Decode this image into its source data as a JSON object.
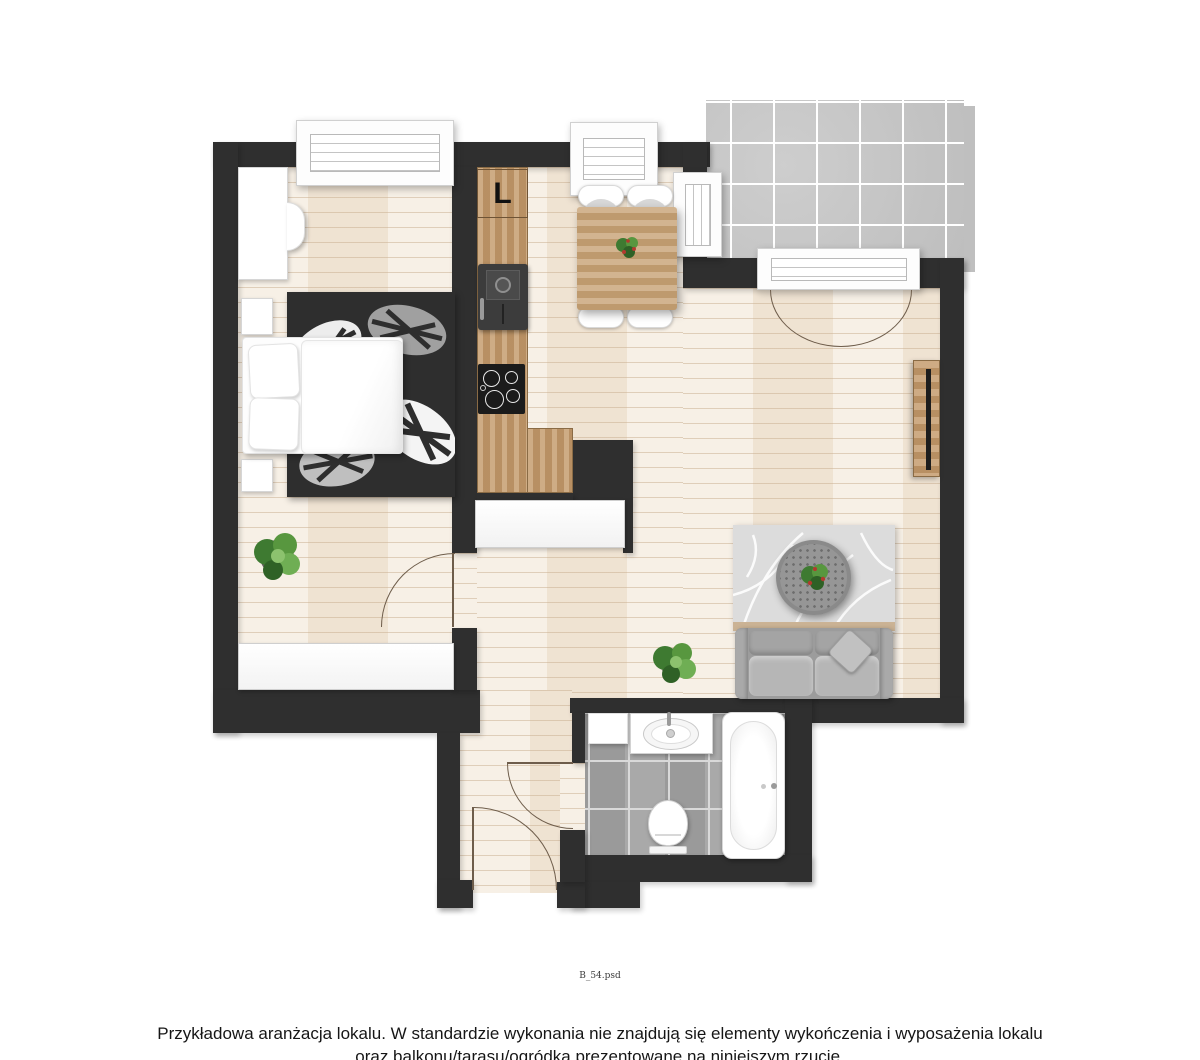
{
  "plan": {
    "fridge_label": "L",
    "file_label": "B_54.psd"
  },
  "disclaimer": {
    "line1": "Przykładowa aranżacja lokalu. W standardzie wykonania nie znajdują się elementy wykończenia i wyposażenia lokalu",
    "line2": "oraz balkonu/tarasu/ogródka prezentowane na niniejszym rzucie."
  },
  "colors": {
    "wall": "#2f2f2f",
    "floor_wood": "#f5ecdf",
    "counter_wood": "#c59c6e",
    "table_wood": "#c8a478",
    "balcony_tile": "#c8c8c8",
    "bathroom_tile": "#a4a4a4",
    "rug_bedroom": "#2e2e2e",
    "rug_living": "#dcdcdc",
    "sofa_gray": "#9c9c9c",
    "plant_green": "#4e8b3a",
    "fixture_white": "#ffffff"
  },
  "objects": [
    "wardrobe",
    "bed",
    "nightstand",
    "bedroom-rug",
    "plant",
    "built-in-closet",
    "kitchen-counter",
    "fridge",
    "sink",
    "cooktop",
    "dining-table",
    "dining-chair",
    "window",
    "balcony",
    "balcony-door",
    "tv-sideboard",
    "living-rug",
    "coffee-table",
    "sofa",
    "washer",
    "washbasin-vanity",
    "toilet",
    "bathtub",
    "door-swing"
  ]
}
